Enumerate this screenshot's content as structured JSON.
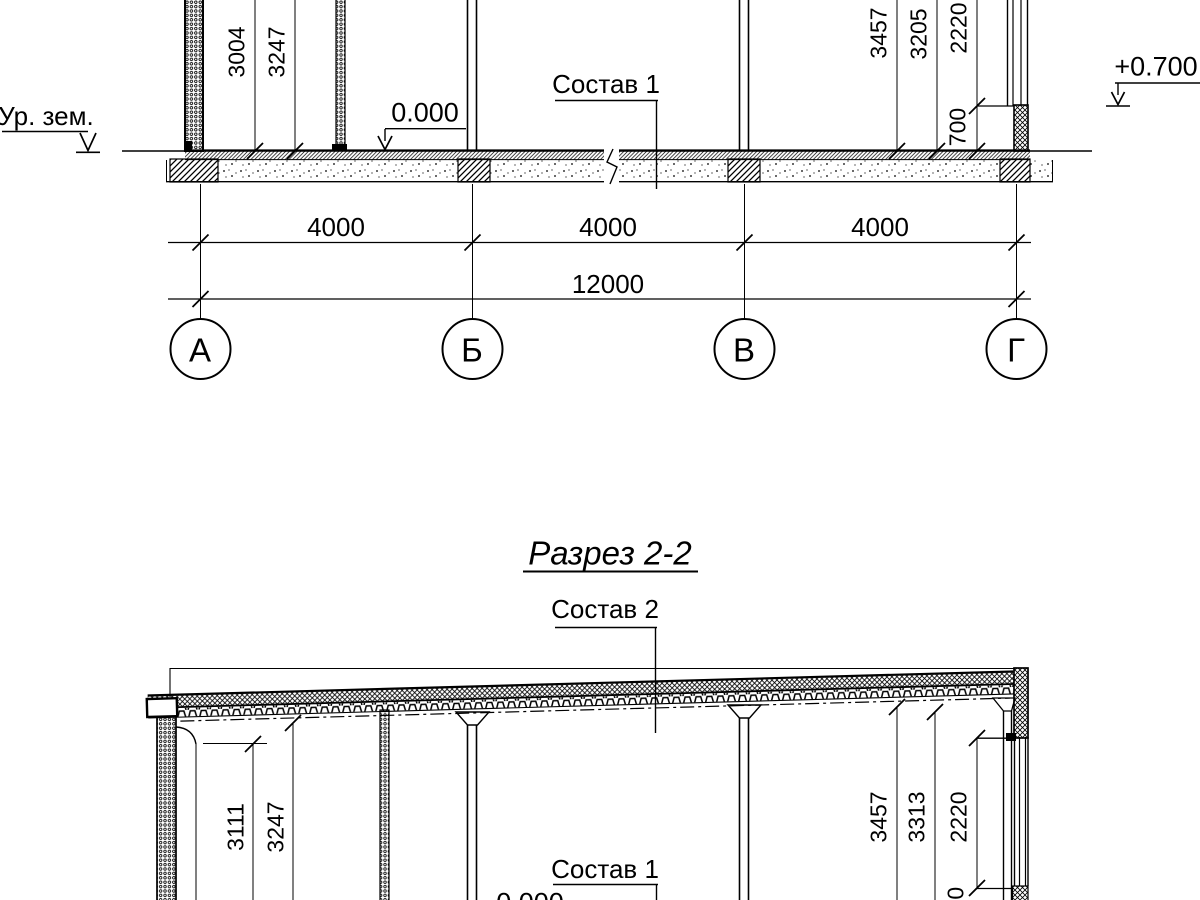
{
  "drawing": {
    "section1": {
      "ground_level_label": "Ур. зем.",
      "zero_elevation": "0.000",
      "parapet_elevation": "+0.700",
      "floor_composition_label": "Состав 1",
      "dim_left_inner": "3004",
      "dim_left_outer": "3247",
      "dim_right_1": "3457",
      "dim_right_2": "3205",
      "dim_right_3": "2220",
      "dim_sill": "700",
      "span_dims": [
        "4000",
        "4000",
        "4000"
      ],
      "total_dim": "12000",
      "axes": [
        "А",
        "Б",
        "В",
        "Г"
      ]
    },
    "section2": {
      "title": "Разрез 2-2",
      "roof_composition_label": "Состав 2",
      "floor_composition_label": "Состав 1",
      "zero_elevation": "0.000",
      "dim_left_inner": "3111",
      "dim_left_outer": "3247",
      "dim_right_1": "3457",
      "dim_right_2": "3313",
      "dim_right_3": "2220",
      "dim_sill": "700"
    }
  }
}
